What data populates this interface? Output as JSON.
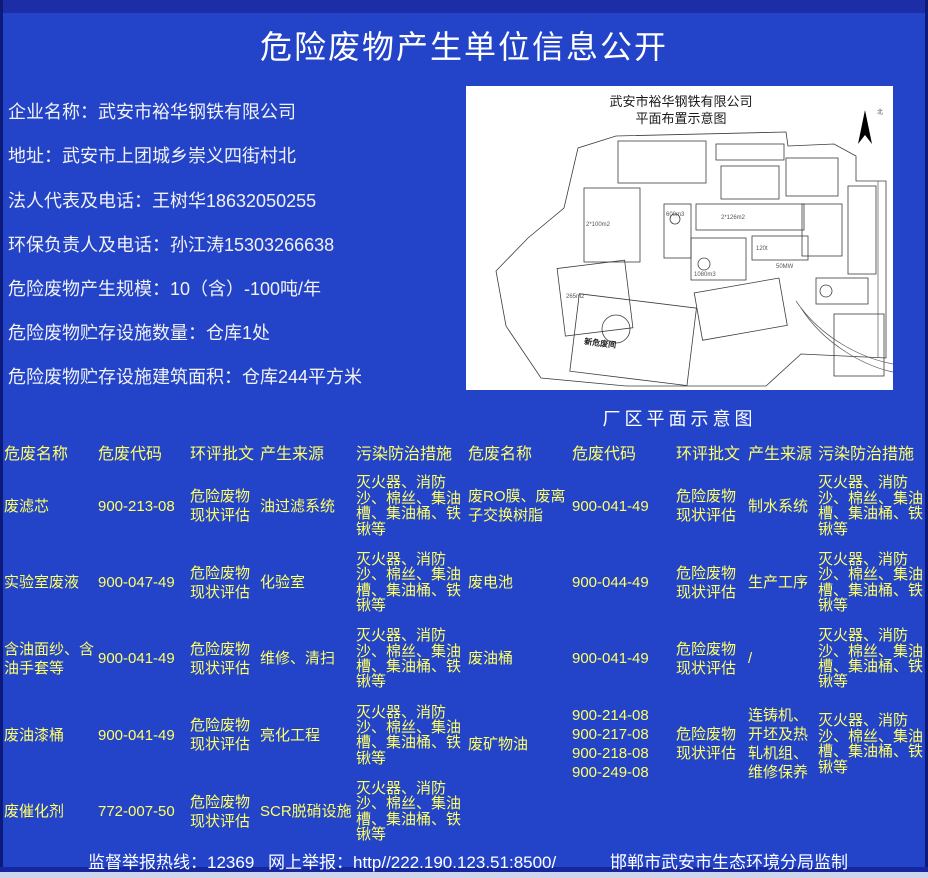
{
  "page_title": "危险废物产生单位信息公开",
  "colors": {
    "background": "#2344c8",
    "frame": "#16279e",
    "table_text": "#ffff66",
    "body_text": "#ffffff"
  },
  "info": {
    "items": [
      "企业名称：武安市裕华钢铁有限公司",
      "地址：武安市上团城乡崇义四街村北",
      "法人代表及电话：王树华18632050255",
      "环保负责人及电话：孙江涛15303266638",
      "危险废物产生规模：10（含）-100吨/年",
      "危险废物贮存设施数量：仓库1处",
      "危险废物贮存设施建筑面积：仓库244平方米"
    ]
  },
  "map": {
    "title_line1": "武安市裕华钢铁有限公司",
    "title_line2": "平面布置示意图",
    "north_label": "北",
    "caption": "厂区平面示意图",
    "area_labels": [
      "新危废间",
      "2*126m2",
      "600m3",
      "1080m3",
      "265m2",
      "2*100m2",
      "120t",
      "50MW"
    ]
  },
  "table": {
    "headers": [
      "危废名称",
      "危废代码",
      "环评批文",
      "产生来源",
      "污染防治措施"
    ],
    "left_rows": [
      [
        "废滤芯",
        "900-213-08",
        "危险废物现状评估",
        "油过滤系统",
        "灭火器、消防沙、棉丝、集油槽、集油桶、铁锹等"
      ],
      [
        "实验室废液",
        "900-047-49",
        "危险废物现状评估",
        "化验室",
        "灭火器、消防沙、棉丝、集油槽、集油桶、铁锹等"
      ],
      [
        "含油面纱、含油手套等",
        "900-041-49",
        "危险废物现状评估",
        "维修、清扫",
        "灭火器、消防沙、棉丝、集油槽、集油桶、铁锹等"
      ],
      [
        "废油漆桶",
        "900-041-49",
        "危险废物现状评估",
        "亮化工程",
        "灭火器、消防沙、棉丝、集油槽、集油桶、铁锹等"
      ],
      [
        "废催化剂",
        "772-007-50",
        "危险废物现状评估",
        "SCR脱硝设施",
        "灭火器、消防沙、棉丝、集油槽、集油桶、铁锹等"
      ]
    ],
    "right_rows": [
      [
        "废RO膜、废离子交换树脂",
        "900-041-49",
        "危险废物现状评估",
        "制水系统",
        "灭火器、消防沙、棉丝、集油槽、集油桶、铁锹等"
      ],
      [
        "废电池",
        "900-044-49",
        "危险废物现状评估",
        "生产工序",
        "灭火器、消防沙、棉丝、集油槽、集油桶、铁锹等"
      ],
      [
        "废油桶",
        "900-041-49",
        "危险废物现状评估",
        "/",
        "灭火器、消防沙、棉丝、集油槽、集油桶、铁锹等"
      ],
      [
        "废矿物油",
        "900-214-08\n900-217-08\n900-218-08\n900-249-08",
        "危险废物现状评估",
        "连铸机、开坯及热轧机组、维修保养",
        "灭火器、消防沙、棉丝、集油槽、集油桶、铁锹等"
      ]
    ]
  },
  "footer": {
    "hotline": "监督举报热线：12369",
    "online": "网上举报：http//222.190.123.51:8500/",
    "producer": "邯郸市武安市生态环境分局监制"
  }
}
